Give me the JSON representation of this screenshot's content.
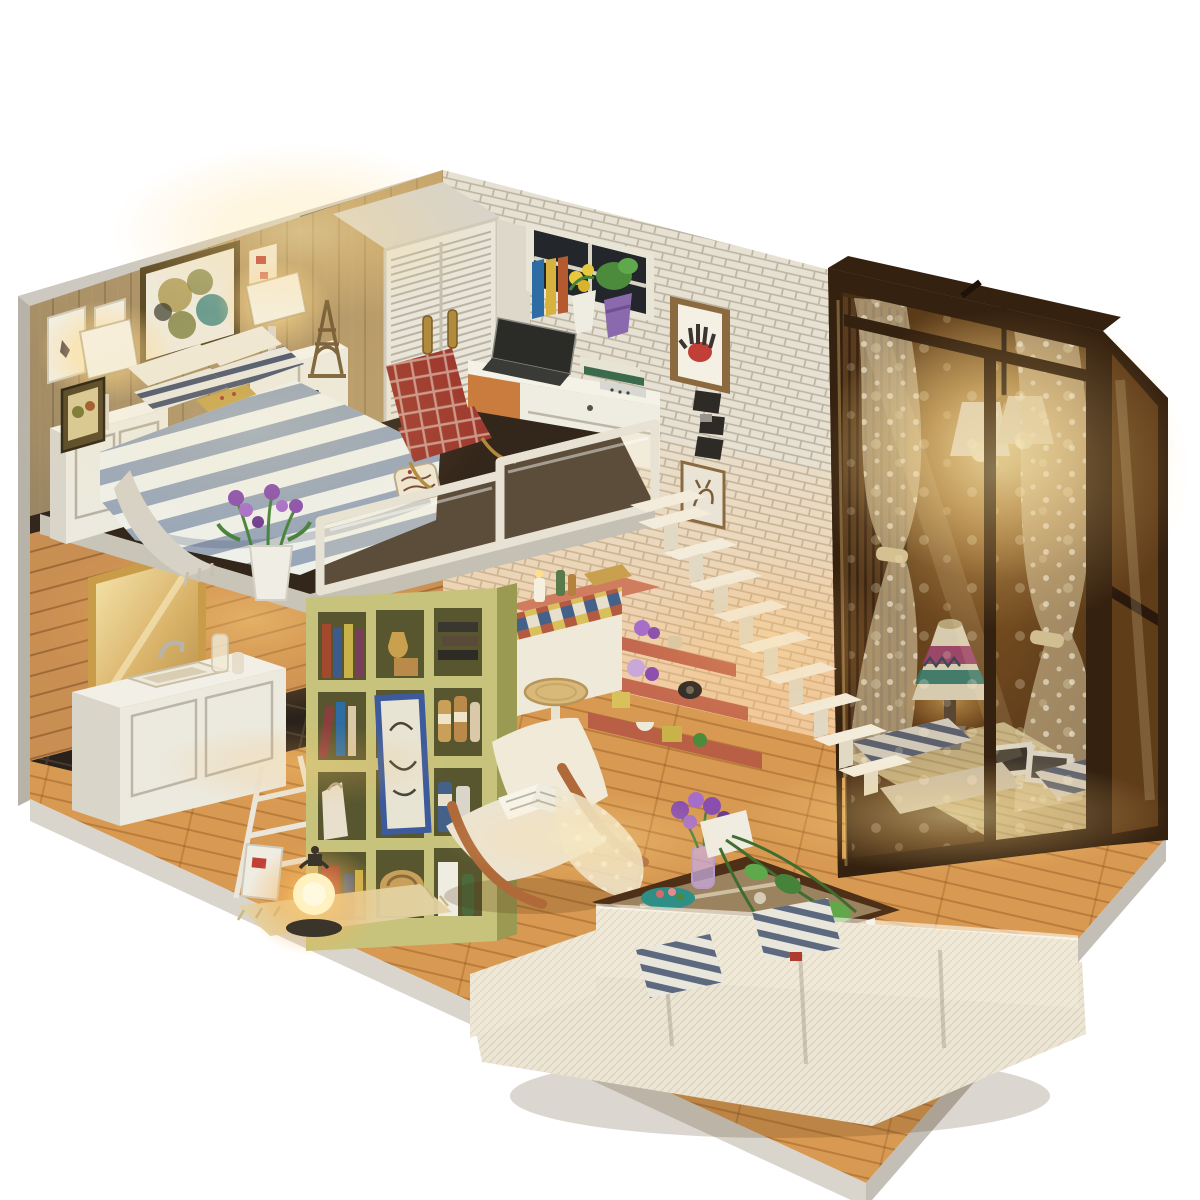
{
  "image": {
    "kind": "photograph",
    "subject": "DIY miniature dollhouse loft-apartment diorama with warm LED lighting on a seamless white background",
    "view": "three-quarter corner view, two storeys: loft bedroom above, living area below"
  },
  "palette": {
    "background": "#ffffff",
    "base_edge": "#cdc9c0",
    "base_side_left": "#d9d5cd",
    "base_side_right": "#c3bfb6",
    "wall_plank": "#8d7c61",
    "wall_brick": "#e7e1d3",
    "bathroom_wood": "#c98e52",
    "loft_slab": "#33261a",
    "fascia_gray": "#c9c4b8",
    "floor_wood": "#d89a52",
    "floor_tile": "#2a211a",
    "bookshelf_front": "#c8c37c",
    "bookshelf_side": "#9a9a52",
    "counter_top": "#d07c5f",
    "counter_face": "#efe9da",
    "stairs_white": "#f3ecdb",
    "under_stair_shelf": "#c4694f",
    "wardrobe_white": "#e9e5d8",
    "window_frame_dark": "#35210f",
    "lace_curtain": "#f2e4bc",
    "pendant_shade": "#f7efd8",
    "duvet_base": "#eef0ea",
    "duvet_stripe": "#8fa0b5",
    "pillow_navy": "#3c4a63",
    "pillow_mustard": "#c7a44c",
    "plaid_red": "#9e3a2e",
    "sofa_cream": "#ece5d4",
    "chair_arm_wood": "#b06a3a",
    "table_wood": "#4e3018",
    "plant_green": "#47823a",
    "rug_tan": "#e4d2a2",
    "mirror_gold": "#c99c4a",
    "vanity_white": "#eceadf",
    "lantern_glow": "#fff2c0",
    "lamp_magenta": "#a03a6e",
    "lamp_teal": "#2e7f74",
    "flower_purple": "#8a4fae",
    "bowl_teal": "#2f8f86",
    "glow_warm": "#ffd98a"
  },
  "scene": {
    "upper_loft": [
      "vertical plank accent wall",
      "circle-collage framed art",
      "two ballet print frames",
      "small red mini frame",
      "lit table lamps on white nightstands",
      "leaning photo frame",
      "bed with blue-white striped duvet",
      "navy striped pillows",
      "mustard floral pillow",
      "knit throw",
      "script tag on duvet",
      "potted purple lavender at loft edge",
      "eiffel tower figurine",
      "white louvered wardrobe with brass handles",
      "red plaid armchair",
      "white desk with laptop, books, calculator",
      "window with dark panes, book row, yellow and green plants",
      "white brick wall",
      "framed handprint artwork",
      "column of black and white photos",
      "deer sketch frame",
      "rounded white glass balustrade"
    ],
    "lower_floor": [
      "honey wood plank bathroom wall",
      "gold framed mirror",
      "white vanity with sink and faucet",
      "toiletry bottles",
      "dark tile bathroom floor",
      "white ladder rack",
      "olive cubby bookshelf with books, jars, canisters and blue-framed sketch",
      "paper bag and basket",
      "glowing lantern on small rug",
      "leaning magazines",
      "mosaic tiled bar counter with candle, bottles and gold book",
      "rattan bar stool",
      "white floating staircase",
      "salmon under-stair shelves with teapots, flowers and boxes",
      "white boucle lounge chair with bent wood arms",
      "open book and lace throw on chair",
      "glass coffee table with dark wood frame",
      "purple posy in faceted vase",
      "teal trinket bowl",
      "pothos plant in white planter",
      "white boucle corner sofa",
      "navy ticking striped cushions",
      "plank wood floor"
    ],
    "window_bay": [
      "dark wood framed glass bay",
      "polka-dot lace curtains tied at the waist",
      "wood slat blind",
      "pendant light with paper shades lit",
      "striped floor cushions",
      "folk-pattern table lamp",
      "photo prints on rug",
      "woven tan rug"
    ],
    "base": [
      "white display base platform"
    ]
  }
}
